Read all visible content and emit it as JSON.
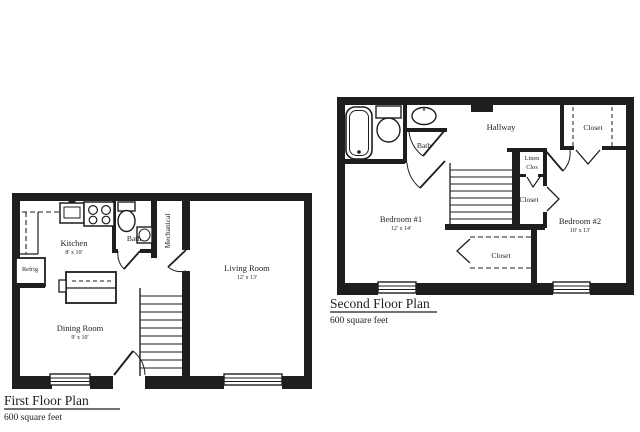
{
  "colors": {
    "background": "#ffffff",
    "ink": "#1e1e1e"
  },
  "first_floor": {
    "title": "First Floor Plan",
    "area": "600 square feet",
    "rooms": {
      "kitchen": {
        "name": "Kitchen",
        "dims": "8' x 10'"
      },
      "bath": {
        "name": "Bath"
      },
      "mechanical": {
        "name": "Mechanical"
      },
      "living_room": {
        "name": "Living Room",
        "dims": "12' x 13'"
      },
      "dining_room": {
        "name": "Dining Room",
        "dims": "9' x 10'"
      },
      "refrigerator": {
        "name": "Refrig"
      }
    }
  },
  "second_floor": {
    "title": "Second Floor Plan",
    "area": "600 square feet",
    "rooms": {
      "bath": {
        "name": "Bath"
      },
      "hallway": {
        "name": "Hallway"
      },
      "closet_hall": {
        "name": "Closet"
      },
      "linen_closet": {
        "line1": "Linen",
        "line2": "Clos"
      },
      "closet_mid": {
        "name": "Closet"
      },
      "closet_bedroom1": {
        "name": "Closet"
      },
      "bedroom1": {
        "name": "Bedroom #1",
        "dims": "12' x 14'"
      },
      "bedroom2": {
        "name": "Bedroom #2",
        "dims": "10' x 13'"
      }
    }
  }
}
